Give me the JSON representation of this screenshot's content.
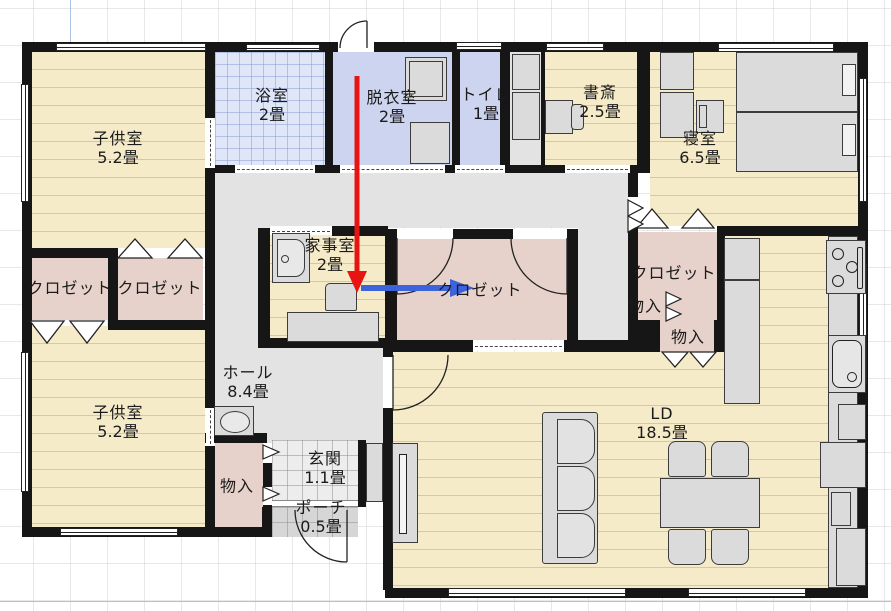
{
  "title": "日本間取り図 (Japanese floor plan)",
  "rooms": [
    {
      "id": "kodomo1",
      "label": "子供室",
      "area": "5.2畳"
    },
    {
      "id": "bath",
      "label": "浴室",
      "area": "2畳"
    },
    {
      "id": "datsui",
      "label": "脱衣室",
      "area": "2畳"
    },
    {
      "id": "toilet",
      "label": "トイレ",
      "area": "1畳"
    },
    {
      "id": "shosai",
      "label": "書斎",
      "area": "2.5畳"
    },
    {
      "id": "shinshitsu",
      "label": "寝室",
      "area": "6.5畳"
    },
    {
      "id": "closet1",
      "label": "クロゼット",
      "area": ""
    },
    {
      "id": "closet2",
      "label": "クロゼット",
      "area": ""
    },
    {
      "id": "kaji",
      "label": "家事室",
      "area": "2畳"
    },
    {
      "id": "wic",
      "label": "クロゼット",
      "area": ""
    },
    {
      "id": "closet3",
      "label": "クロゼット",
      "area": ""
    },
    {
      "id": "monoA",
      "label": "物入",
      "area": ""
    },
    {
      "id": "monoB",
      "label": "物入",
      "area": ""
    },
    {
      "id": "hall",
      "label": "ホール",
      "area": "8.4畳"
    },
    {
      "id": "kodomo2",
      "label": "子供室",
      "area": "5.2畳"
    },
    {
      "id": "monoC",
      "label": "物入",
      "area": ""
    },
    {
      "id": "genkan",
      "label": "玄関",
      "area": "1.1畳"
    },
    {
      "id": "porch",
      "label": "ポーチ",
      "area": "0.5畳"
    },
    {
      "id": "ld",
      "label": "LD",
      "area": "18.5畳"
    }
  ],
  "annotations": {
    "red_arrow_direction": "down",
    "blue_arrow_direction": "right"
  },
  "colors": {
    "wood_floor": "#f6ebc9",
    "bath_tile": "#dee6f7",
    "sanitary_floor": "#ccd4ef",
    "hall_floor": "#e3e3e3",
    "closet_floor": "#e6d2ca",
    "wall": "#161616",
    "red_arrow": "#e81414",
    "blue_arrow": "#3c63dc"
  },
  "icons": [
    "bed",
    "sofa",
    "dining-table",
    "dining-chair",
    "stove",
    "kitchen-sink",
    "washbasin",
    "washing-machine",
    "tv-board",
    "desk",
    "cabinet",
    "door-swing-arc",
    "bifold-door",
    "window"
  ]
}
